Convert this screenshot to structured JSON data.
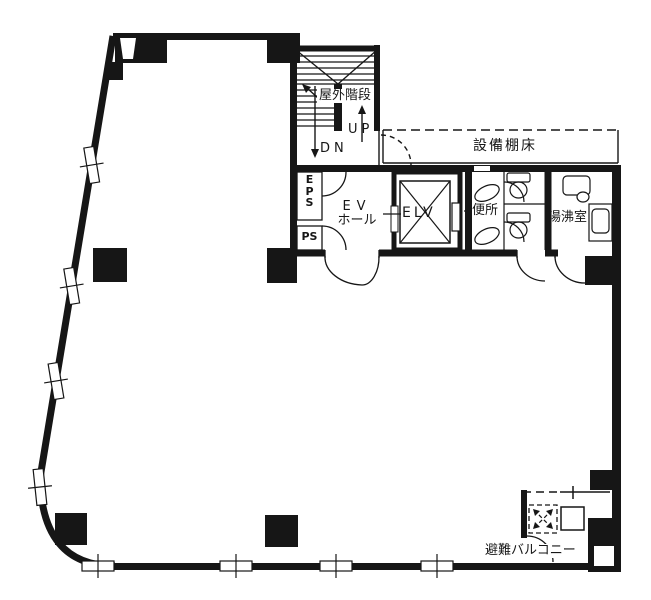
{
  "colors": {
    "background": "#ffffff",
    "line": "#161616"
  },
  "plan": {
    "type": "architectural-floor-plan",
    "labels": {
      "outdoor_stairs": "屋外階段",
      "up": "UP",
      "dn": "DN",
      "equipment_shelf": "設備棚床",
      "eps_letters": [
        "E",
        "P",
        "S"
      ],
      "ps": "PS",
      "ev_hall_line1": "EV",
      "ev_hall_line2": "ホール",
      "elevator": "ELV",
      "toilet": "便所",
      "kitchenette": "湯沸室",
      "escape_balcony": "避難バルコニー"
    }
  }
}
